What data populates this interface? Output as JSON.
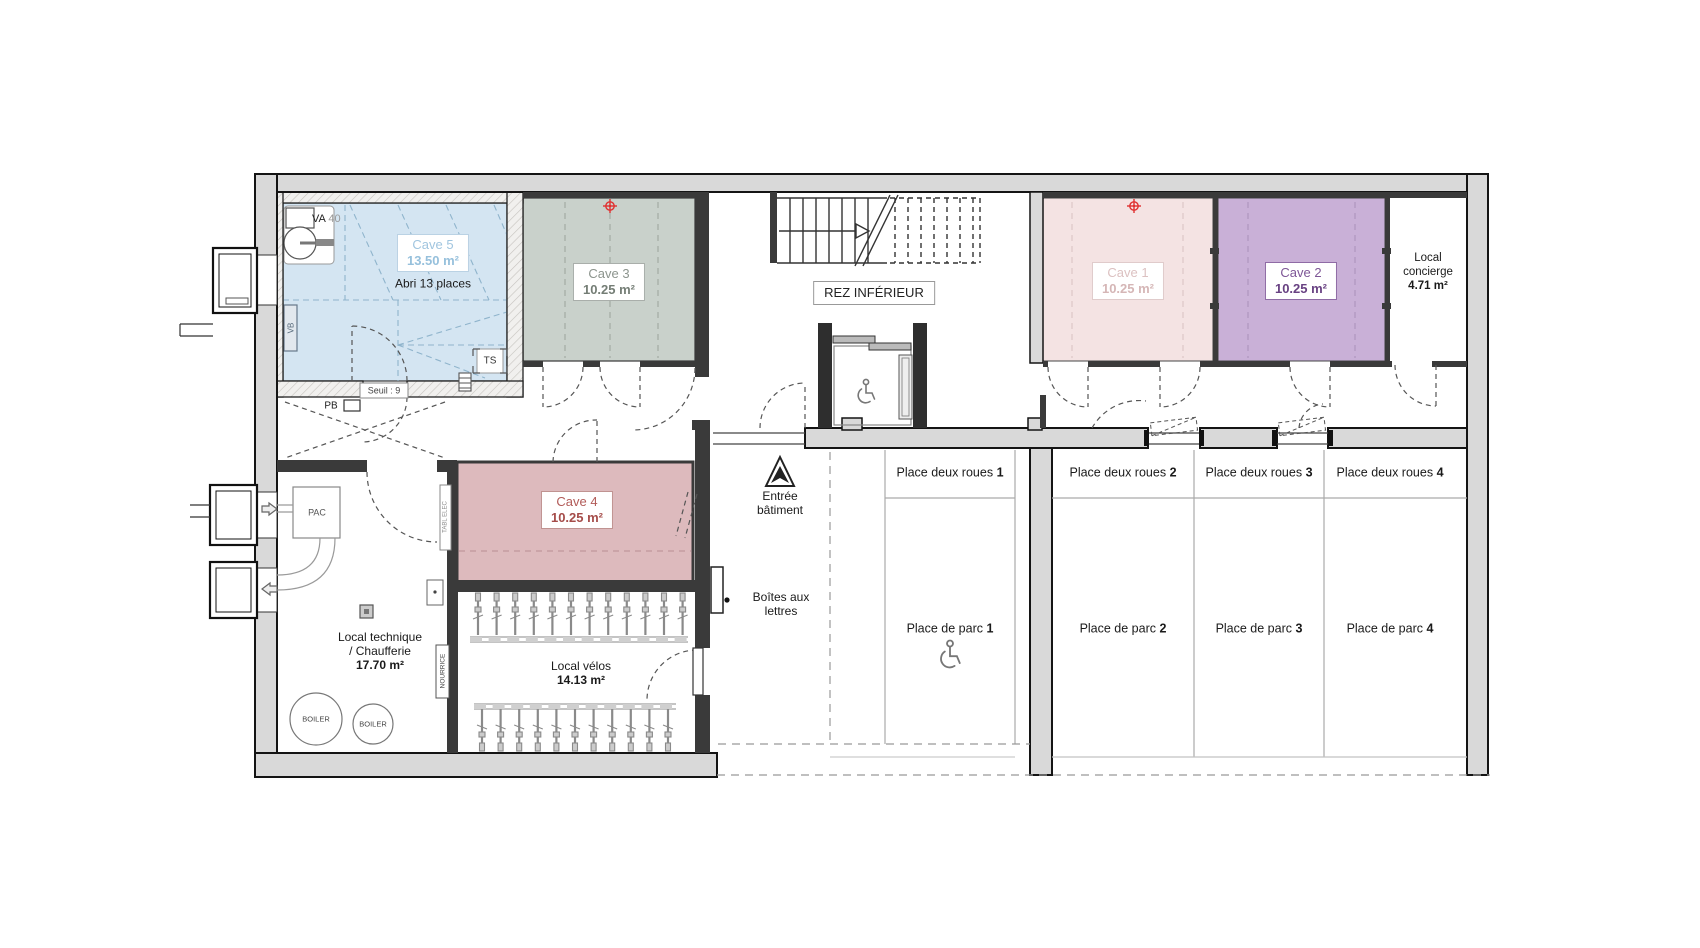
{
  "floor": {
    "label": "REZ INFÉRIEUR"
  },
  "rooms": {
    "cave5": {
      "name": "Cave 5",
      "area": "13.50 m²",
      "note": "Abri 13 places",
      "color": "#d4e5f2",
      "text_color": "#9fc4de"
    },
    "cave3": {
      "name": "Cave 3",
      "area": "10.25 m²",
      "color": "#c9d1cb",
      "text_color": "#868e87"
    },
    "cave1": {
      "name": "Cave 1",
      "area": "10.25 m²",
      "color": "#f4e3e3",
      "text_color": "#d9bcbc"
    },
    "cave2": {
      "name": "Cave 2",
      "area": "10.25 m²",
      "color": "#c9b0d7",
      "text_color": "#6d4587"
    },
    "cave4": {
      "name": "Cave 4",
      "area": "10.25 m²",
      "color": "#ddbabd",
      "text_color": "#ad5a56"
    },
    "concierge": {
      "name_line1": "Local",
      "name_line2": "concierge",
      "area": "4.71 m²"
    },
    "technique": {
      "name_line1": "Local technique",
      "name_line2": "/ Chaufferie",
      "area": "17.70 m²"
    },
    "velos": {
      "name": "Local vélos",
      "area": "14.13 m²"
    }
  },
  "entrance": {
    "line1": "Entrée",
    "line2": "bâtiment"
  },
  "mailboxes": {
    "line1": "Boîtes aux",
    "line2": "lettres"
  },
  "parking": {
    "spots": [
      {
        "bike_label": "Place deux roues",
        "car_label": "Place de parc",
        "num": "1"
      },
      {
        "bike_label": "Place deux roues",
        "car_label": "Place de parc",
        "num": "2"
      },
      {
        "bike_label": "Place deux roues",
        "car_label": "Place de parc",
        "num": "3"
      },
      {
        "bike_label": "Place deux roues",
        "car_label": "Place de parc",
        "num": "4"
      }
    ]
  },
  "annotations": {
    "va": "VA",
    "va_num": "40",
    "vb": "VB",
    "ts": "TS",
    "pb": "PB",
    "seuil": "Seuil : 9",
    "pac": "PAC",
    "boiler1": "BOILER",
    "boiler2": "BOILER",
    "tabl_elec": "TABL ELEC",
    "nourrice": "NOURRICE"
  }
}
